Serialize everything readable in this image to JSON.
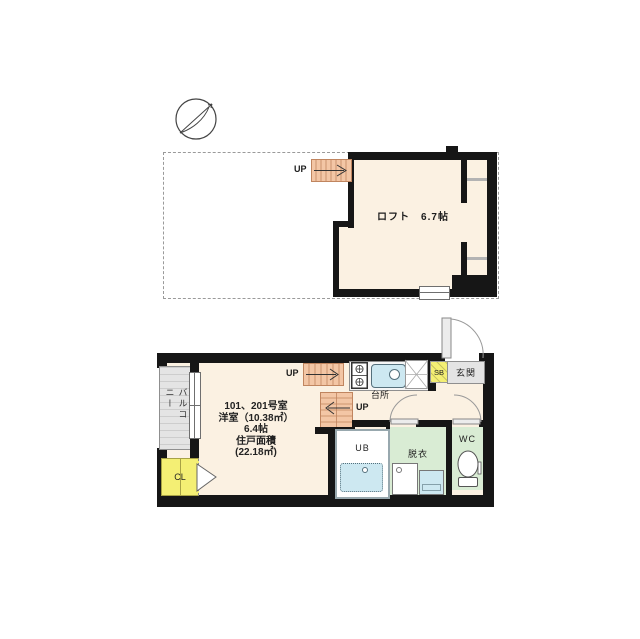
{
  "colors": {
    "wall": "#161616",
    "cream": "#fbf1e2",
    "salmon": "#f3c6a5",
    "stairline": "#c0855f",
    "yellow": "#f4ef74",
    "green": "#d9ecd4",
    "blue": "#cde8f1",
    "grayfloor": "#e4e4e4",
    "dashline": "#9a9a9a"
  },
  "loft_plan": {
    "room_label": "ロフト　6.7帖",
    "up_label": "UP"
  },
  "main_plan": {
    "balcony_label": "バルコニー",
    "closet_label": "CL",
    "kitchen_label": "台所",
    "shoebox_label": "SB",
    "entrance_label": "玄関",
    "bath_label": "UB",
    "dressing_label": "脱衣",
    "toilet_label": "WC",
    "up_label_1": "UP",
    "up_label_2": "UP",
    "room_info_lines": [
      "101、201号室",
      "洋室（10.38㎡）",
      "6.4帖",
      "住戸面積",
      "(22.18㎡)"
    ]
  }
}
